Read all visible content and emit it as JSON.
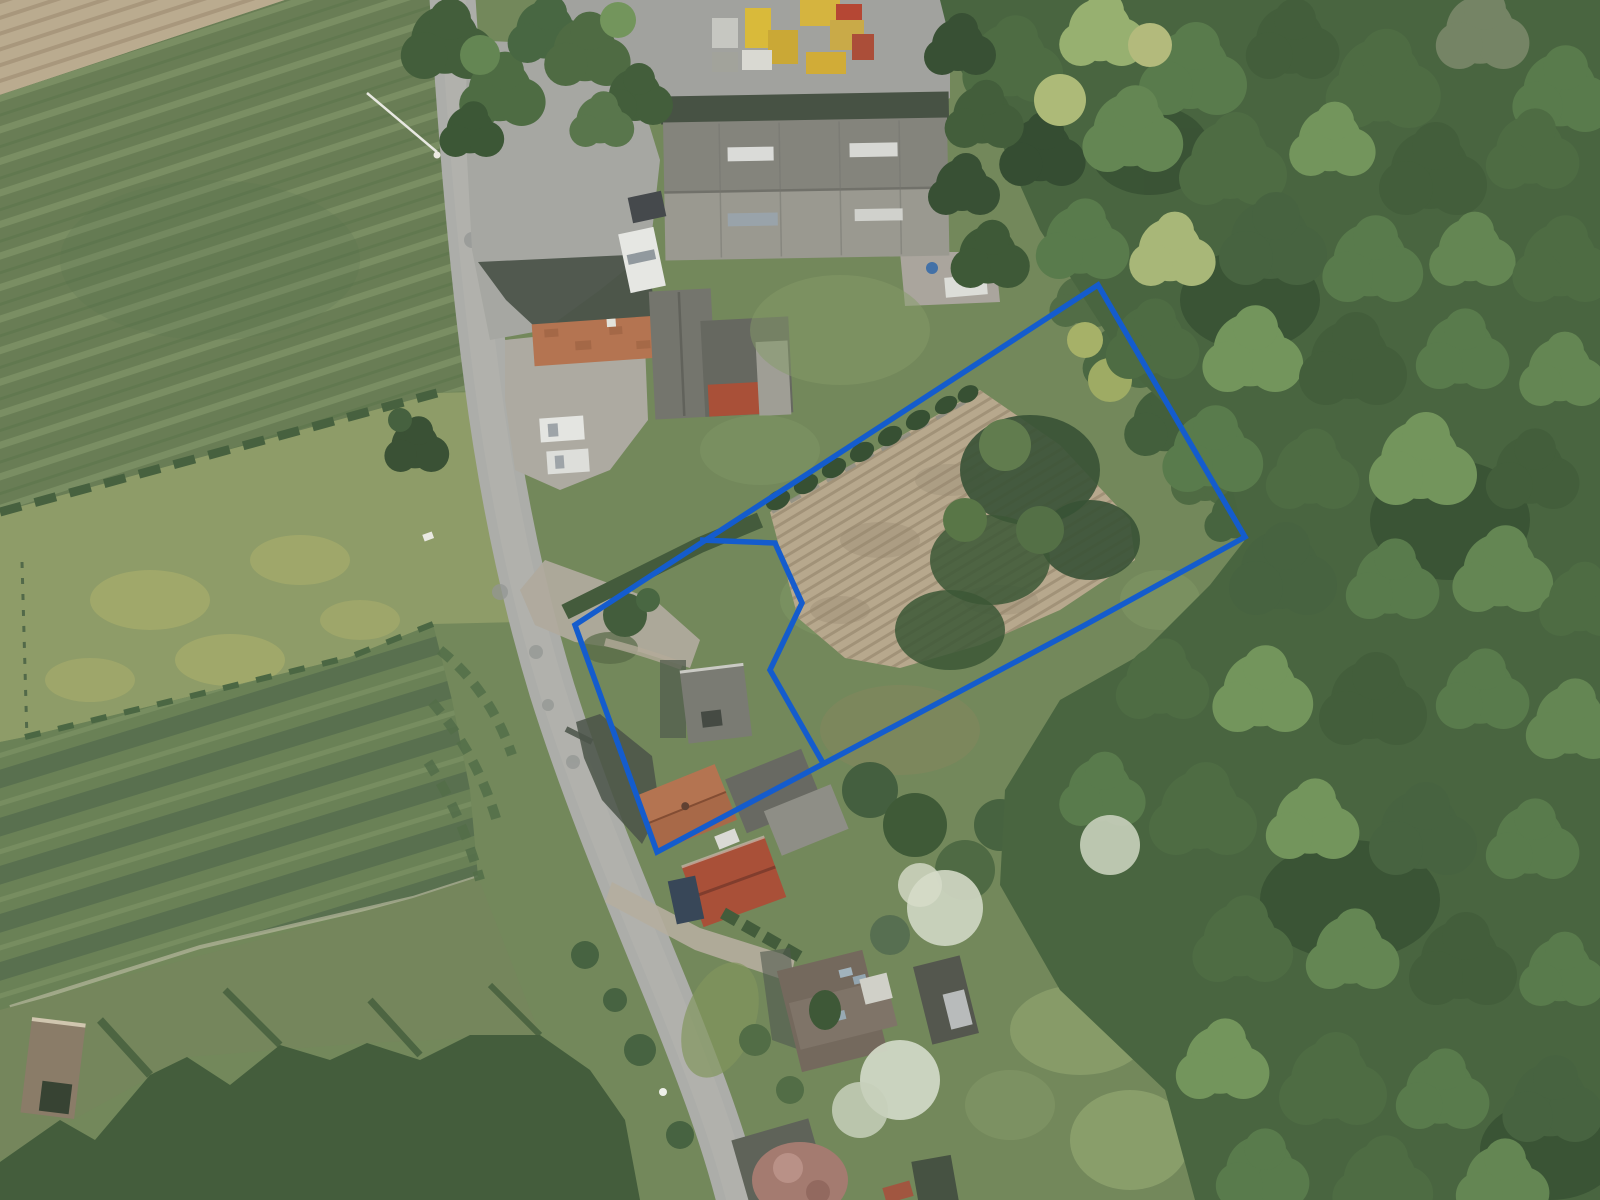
{
  "overlay": {
    "color": "#145ccd",
    "stroke_width": 5.5,
    "parcel_outline": "1098,285 1245,537 1085,625 657,852 575,625",
    "parcel_divider": "700,540 775,543 802,603 770,670 823,763"
  },
  "scene": {
    "colors": {
      "grass_base": "#6d8355",
      "forest_base": "#415e38",
      "road_surface": "#a9aaa7",
      "paved_yard": "#9e9f9b",
      "plowed_field": "#b5a58a",
      "bare_field": "#b8a88c",
      "meadow": "#8a9862",
      "scrub": "#3b5634",
      "warehouse_roof_north": "#7f7f78",
      "warehouse_roof_south": "#96958d",
      "tile_roof_orange": "#b26e4a",
      "tile_roof_red": "#a64830"
    }
  }
}
